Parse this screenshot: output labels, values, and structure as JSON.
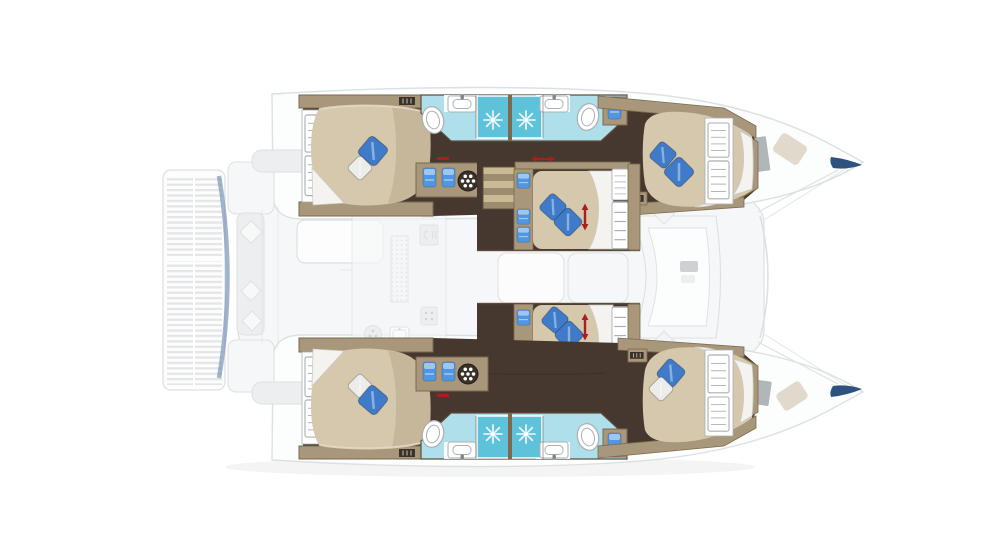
{
  "meta": {
    "description": "Top-down interior deck plan of a sailing catamaran, bow pointing right; lower-deck cabins and bathrooms drawn vividly, exterior decks and saloon ghosted/faded",
    "visible_text": ""
  },
  "colors": {
    "background": "#ffffff",
    "hullFloor": "#46382e",
    "hullFloorStreak": "#32261e",
    "wood": "#a8977a",
    "woodLight": "#c6b593",
    "woodDark": "#7c6950",
    "wallLine": "#5e4f3f",
    "grilleDark": "#3a3128",
    "bed": "#d5c8ad",
    "bedShade": "#baa98b",
    "sheetWhite": "#f4f3f0",
    "sheetShadow": "#cfccc4",
    "pillowBlue": "#3f7bc9",
    "pillowWhite": "#ececea",
    "bathFloor": "#aedfea",
    "showerPan": "#5fc2db",
    "fixtureWhite": "#ffffff",
    "fixtureLine": "#a9b0b4",
    "towelBlue": "#4f97e3",
    "stairTread": "#c9b995",
    "stairRiser": "#9d8c6d",
    "arrowRed": "#a8201d",
    "navyAccent": "#2e527e",
    "steelBlue": "#7895b8",
    "fadedFill": "#f6f7f8",
    "fadedLine": "#dde0e2",
    "fadedMid": "#eceef0",
    "fadedDark": "#cdd1d3",
    "windowGray": "#a5aaae",
    "hatchTan": "#d9cfbe",
    "shadow": "#b9bdbf"
  },
  "plan": {
    "vessel": "sailing-catamaran",
    "view": "top-down-deck-plan",
    "bow_direction": "right",
    "highlighted_zones": [
      "port-hull-accommodations",
      "starboard-hull-accommodations",
      "midship-cabins"
    ],
    "faded_zones": [
      "swim-platform",
      "aft-cockpit",
      "saloon-and-galley",
      "foredeck-lounge",
      "bow-decks"
    ],
    "cabins": [
      {
        "id": "port-aft-cabin",
        "bed": "double",
        "pillows": [
          "blue",
          "white"
        ],
        "features": [
          "wardrobe-louvers"
        ]
      },
      {
        "id": "port-forward-cabin",
        "bed": "double",
        "pillows": [
          "blue",
          "blue"
        ],
        "features": [
          "wardrobe-louvers",
          "vent-grille"
        ]
      },
      {
        "id": "port-midship-cabin",
        "bed": "double",
        "pillows": [
          "blue",
          "blue"
        ],
        "features": [
          "companionway-steps",
          "storage-cubbies",
          "bed-extension-arrow",
          "louver-doors"
        ]
      },
      {
        "id": "starboard-midship-cabin",
        "bed": "double",
        "pillows": [
          "blue",
          "blue"
        ],
        "features": [
          "companionway-steps",
          "storage-cubbies",
          "bed-extension-arrow",
          "louver-doors"
        ]
      },
      {
        "id": "starboard-aft-cabin",
        "bed": "double",
        "pillows": [
          "white",
          "blue"
        ],
        "features": [
          "wardrobe-louvers"
        ]
      },
      {
        "id": "starboard-forward-cabin",
        "bed": "double",
        "pillows": [
          "blue",
          "white"
        ],
        "features": [
          "wardrobe-louvers",
          "vent-grille"
        ]
      }
    ],
    "bathrooms": [
      {
        "id": "port-aft-bathroom",
        "fixtures": [
          "toilet",
          "sink",
          "shower"
        ]
      },
      {
        "id": "port-forward-bathroom",
        "fixtures": [
          "sink",
          "shower",
          "toilet",
          "towel-cabinet"
        ]
      },
      {
        "id": "starboard-aft-bathroom",
        "fixtures": [
          "toilet",
          "sink",
          "shower"
        ]
      },
      {
        "id": "starboard-forward-bathroom",
        "fixtures": [
          "sink",
          "shower",
          "toilet",
          "towel-cabinet"
        ]
      }
    ],
    "icons": [
      "shower-drain-starburst-icon",
      "toilet-icon",
      "sink-icon",
      "towel-bin-icon",
      "fan-hatch-icon",
      "stairs-icon",
      "red-double-arrow-icon",
      "vent-grille-icon",
      "galley-burner-icon",
      "galley-sink-icon",
      "deck-window-icon",
      "deck-hatch-icon"
    ],
    "counts": {
      "cabins": 6,
      "beds": 6,
      "showers": 4,
      "toilets": 4,
      "sinks": 4,
      "stairs": 2,
      "red_arrows": 4
    }
  }
}
